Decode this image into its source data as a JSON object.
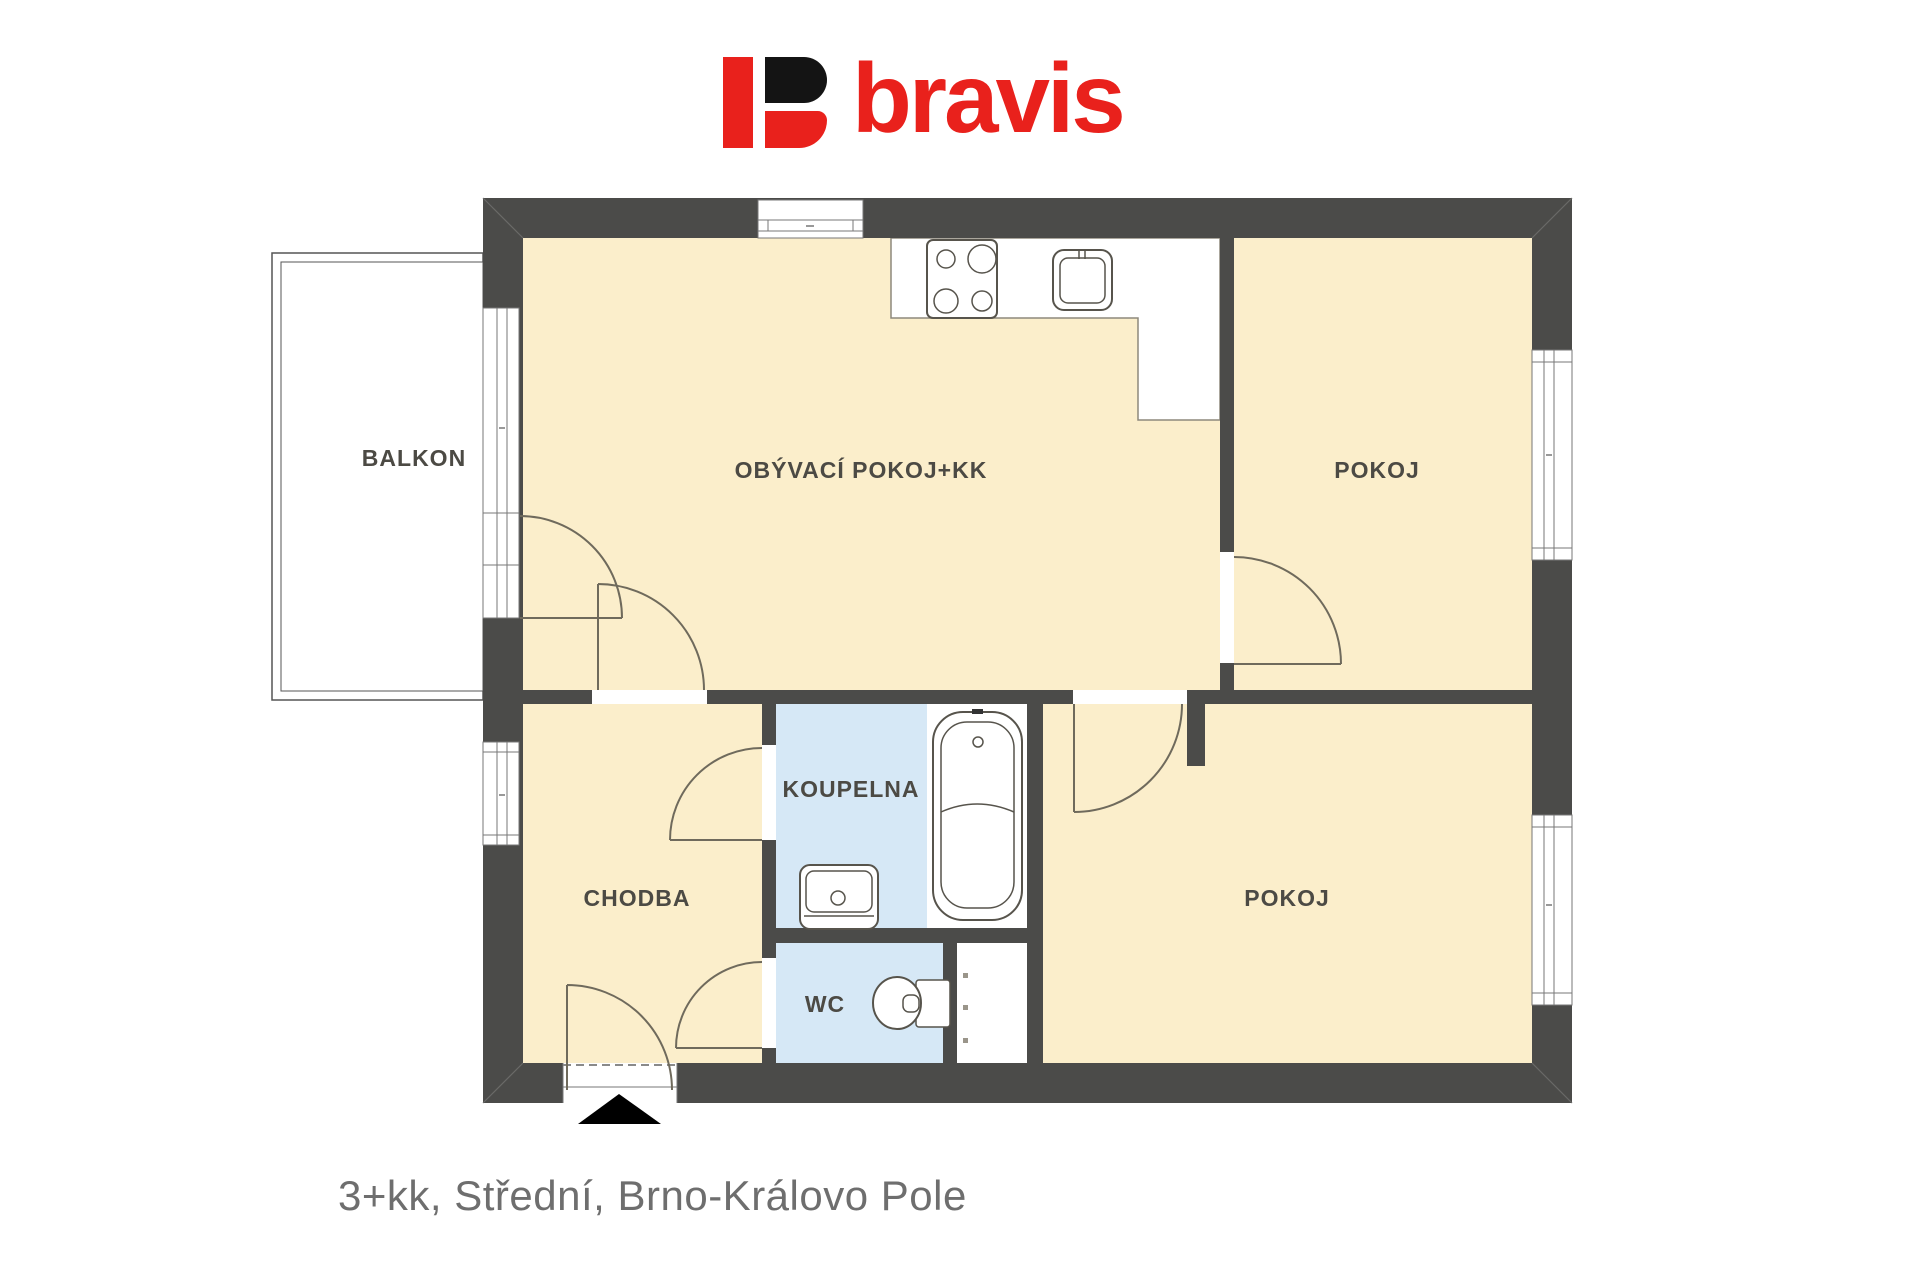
{
  "logo": {
    "brand": "bravis",
    "red": "#e9211c",
    "black": "#141414"
  },
  "caption": "3+kk, Střední, Brno-Královo Pole",
  "rooms": {
    "balkon": "BALKON",
    "living": "OBÝVACÍ POKOJ+KK",
    "pokoj_top": "POKOJ",
    "pokoj_bottom": "POKOJ",
    "koupelna": "KOUPELNA",
    "chodba": "CHODBA",
    "wc": "WC"
  },
  "icons": {
    "entrance_arrow": "filled-triangle-up",
    "stove": "4-burner-cooktop",
    "kitchen_sink": "single-basin-sink",
    "bathtub": "bathtub-top-view",
    "washbasin": "washbasin-top-view",
    "toilet": "toilet-top-view"
  },
  "colors": {
    "wall": "#4b4b49",
    "room_fill": "#fbeecb",
    "wet_room_fill": "#d6e8f6",
    "fixture_line": "#57544c",
    "door_line": "#6f6a5c",
    "label_text": "#4c4a44",
    "caption_text": "#6e6e6e"
  }
}
